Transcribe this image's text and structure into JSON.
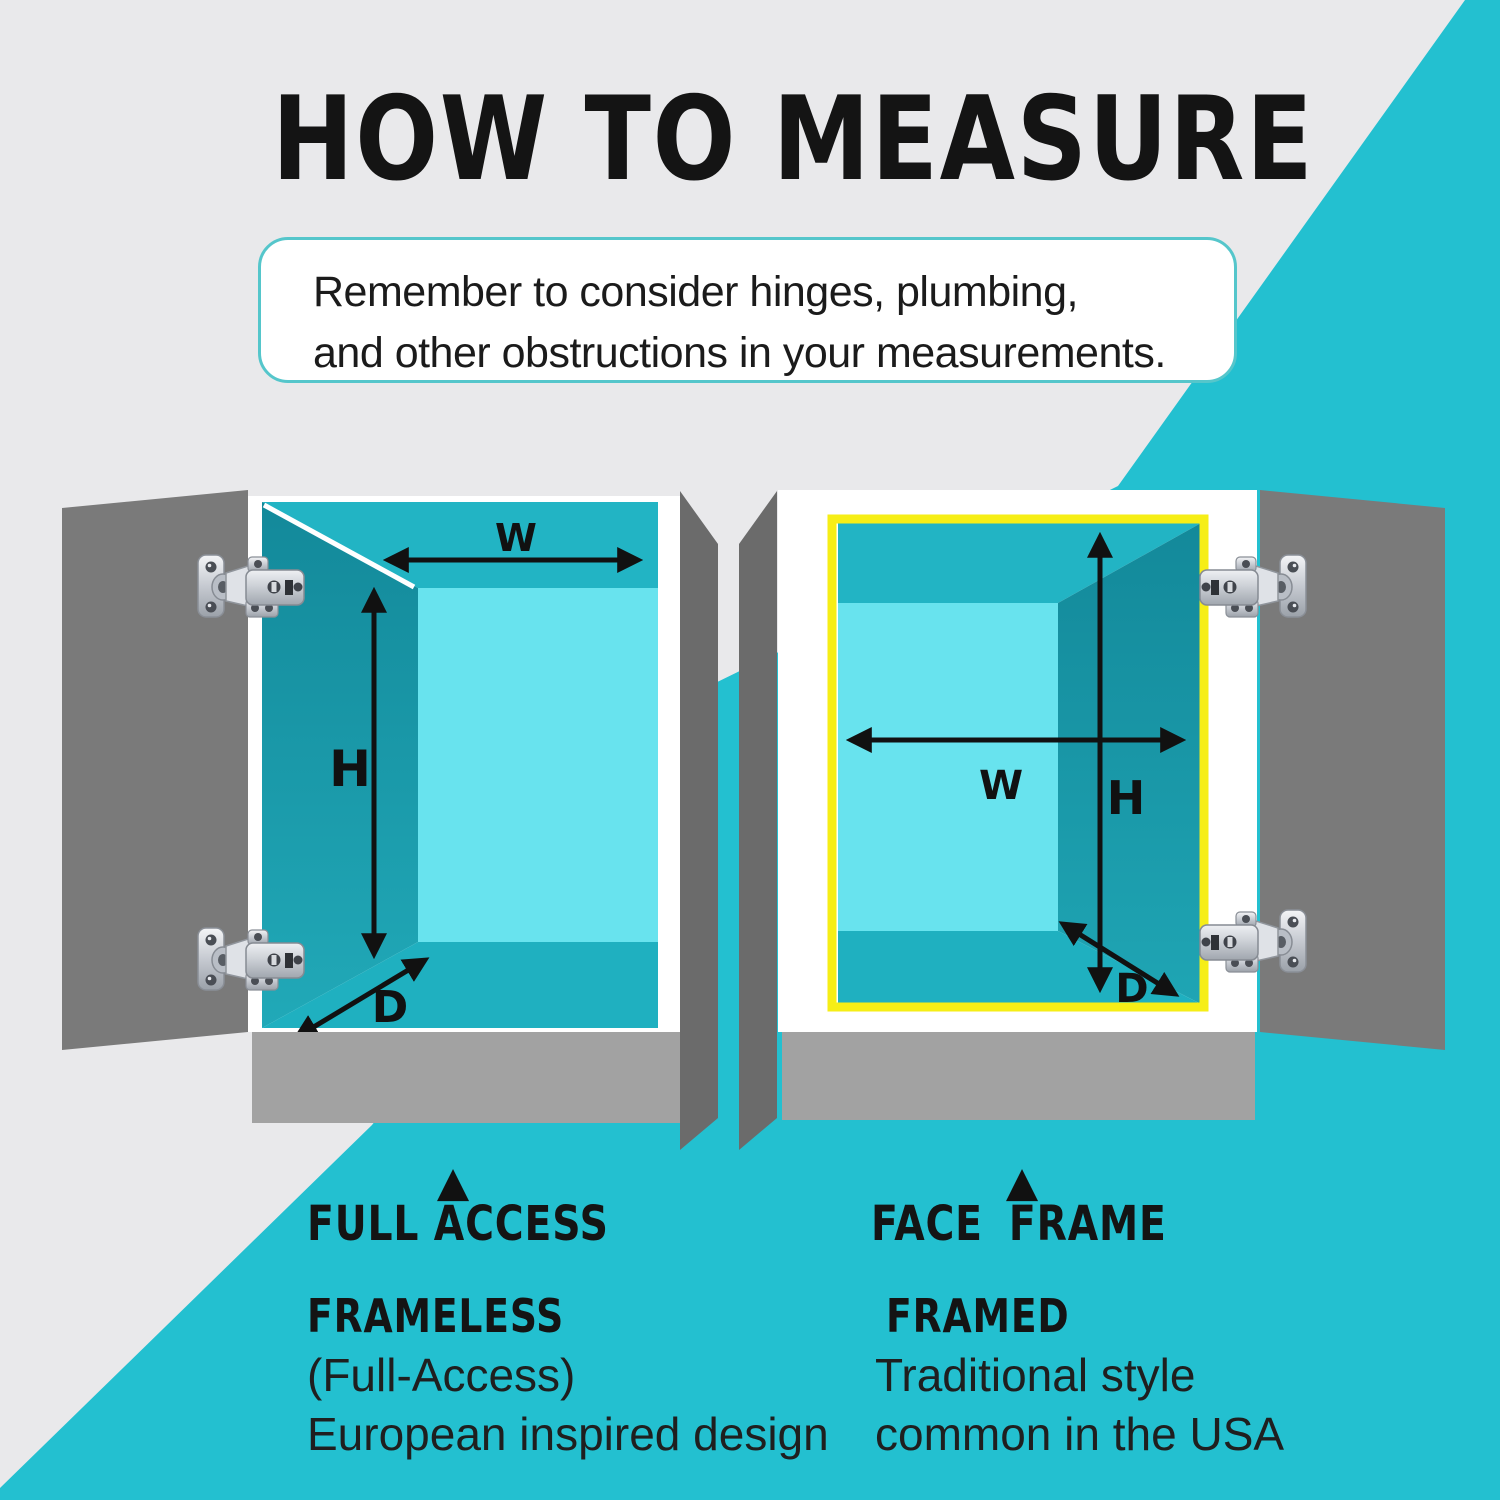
{
  "title": "HOW TO MEASURE",
  "note": {
    "line1": "Remember to consider hinges, plumbing,",
    "line2": "and other obstructions in your measurements."
  },
  "cabinets": {
    "left": {
      "dims": {
        "w": "W",
        "h": "H",
        "d": "D"
      },
      "pointer": "▲",
      "heading": "FULL ACCESS",
      "style_name": "FRAMELESS",
      "desc_line1": "(Full-Access)",
      "desc_line2": "European inspired design"
    },
    "right": {
      "dims": {
        "w": "W",
        "h": "H",
        "d": "D"
      },
      "pointer": "▲",
      "heading": "FACE FRAME",
      "style_name": "FRAMED",
      "desc_line1": "Traditional style",
      "desc_line2": "common in the USA"
    }
  },
  "colors": {
    "background_gray": "#e9e9eb",
    "background_teal": "#23c0d0",
    "interior_ceiling": "#22b4c4",
    "interior_wall": "#17919f",
    "interior_back_wall": "#68e3ee",
    "interior_floor": "#1fb0c0",
    "face_frame_yellow": "#f6ee16",
    "door_gray": "#7a7a7a",
    "side_panel_gray": "#6b6b6b",
    "base_gray": "#a2a2a2",
    "arrow_black": "#111111",
    "note_border": "#55c6cb",
    "text_black": "#141414"
  }
}
